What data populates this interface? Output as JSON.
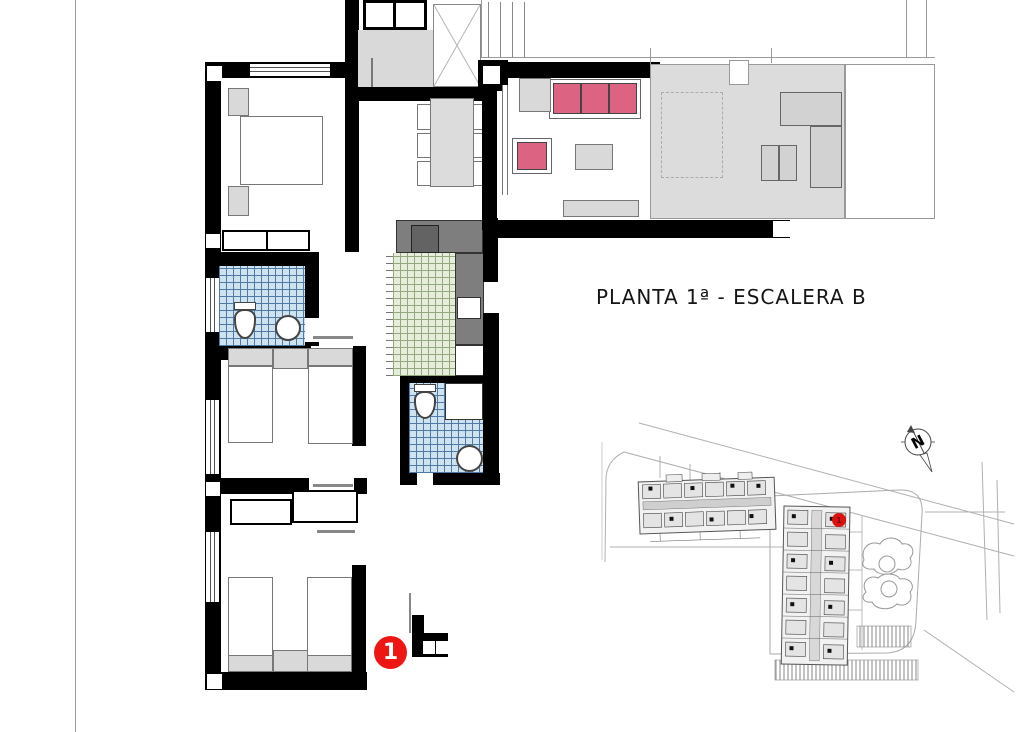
{
  "title": {
    "text": "PLANTA 1ª - ESCALERA B"
  },
  "unit_badge": {
    "number": "1",
    "color": "#ee1515",
    "text_color": "#ffffff"
  },
  "site_plan": {
    "north_label": "N",
    "location_marker_number": "1",
    "marker_color": "#dd1111"
  },
  "palette": {
    "wall": "#000000",
    "terrace_floor": "#dcdcdc",
    "furniture_gray": "#d9d9d9",
    "sofa_pink": "#dd6383",
    "bathroom_tile": "#cfe2f0",
    "bathroom_tile_grid": "#4f7aa5",
    "kitchen_tile": "#e6edda",
    "kitchen_tile_grid": "#93a87e",
    "kitchen_counter": "#7e7e7e",
    "badge_red": "#ee1515"
  }
}
